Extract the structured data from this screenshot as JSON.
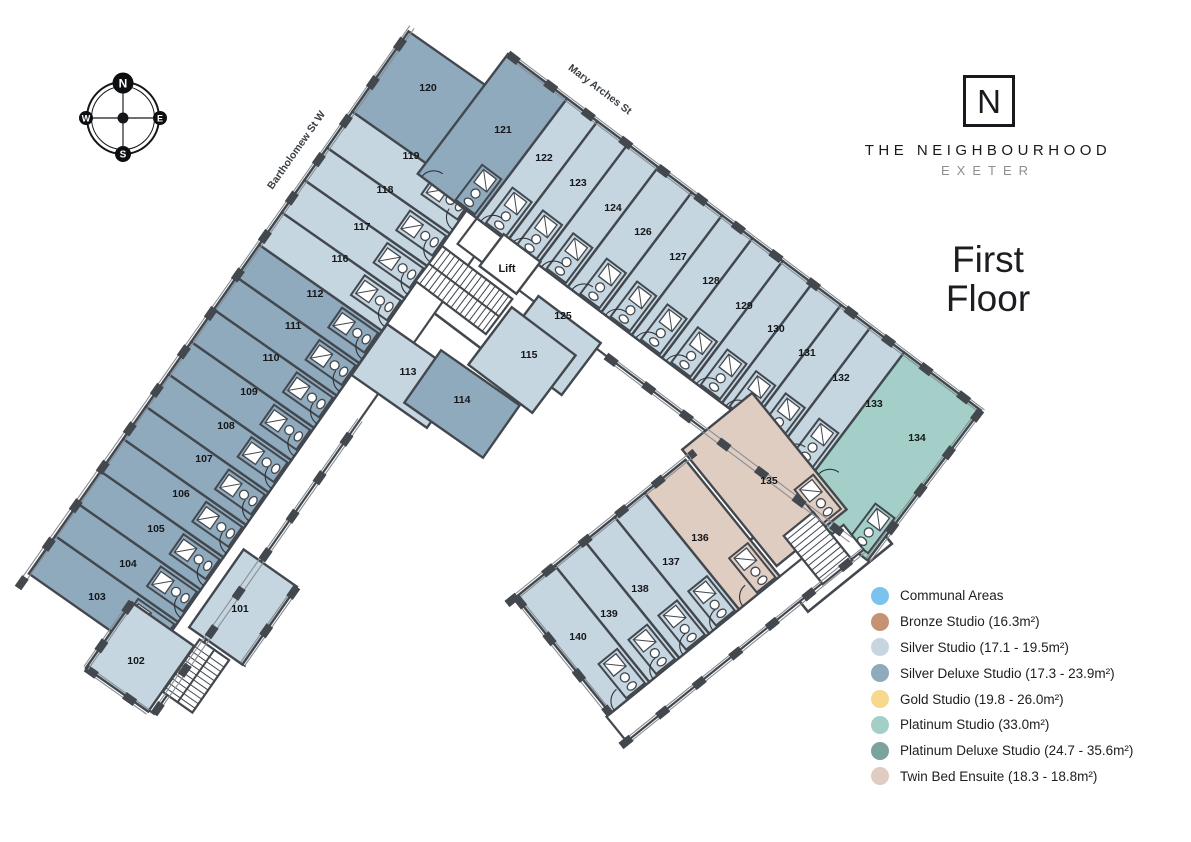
{
  "brand": {
    "logo_letter": "N",
    "name": "THE NEIGHBOURHOOD",
    "city": "EXETER"
  },
  "floor_title": {
    "line1": "First",
    "line2": "Floor"
  },
  "compass": {
    "north": "N",
    "east": "E",
    "south": "S",
    "west": "W"
  },
  "streets": {
    "west": "Bartholomew St W",
    "north": "Mary Arches St"
  },
  "lift_label": "Lift",
  "colors": {
    "wall": "#42484E",
    "window_line": "#888E94",
    "corridor": "#FFFFFF",
    "label_text": "#15171A",
    "categories": {
      "communal": "#79C3EE",
      "bronze": "#C59374",
      "silver": "#C6D6E1",
      "silver_deluxe": "#8FA9BD",
      "gold": "#F8D88D",
      "platinum": "#A3CFC8",
      "platinum_deluxe": "#7CA29C",
      "twin": "#E0CDC2"
    }
  },
  "legend": {
    "items": [
      {
        "label": "Communal Areas",
        "category": "communal"
      },
      {
        "label": "Bronze Studio (16.3m²)",
        "category": "bronze"
      },
      {
        "label": "Silver Studio (17.1 - 19.5m²)",
        "category": "silver"
      },
      {
        "label": "Silver Deluxe Studio (17.3 - 23.9m²)",
        "category": "silver_deluxe"
      },
      {
        "label": "Gold Studio (19.8 - 26.0m²)",
        "category": "gold"
      },
      {
        "label": "Platinum Studio (33.0m²)",
        "category": "platinum"
      },
      {
        "label": "Platinum Deluxe Studio (24.7 - 35.6m²)",
        "category": "platinum_deluxe"
      },
      {
        "label": "Twin Bed Ensuite (18.3 - 18.8m²)",
        "category": "twin"
      }
    ]
  },
  "rooms": [
    {
      "number": "101",
      "category": "silver"
    },
    {
      "number": "102",
      "category": "silver"
    },
    {
      "number": "103",
      "category": "silver_deluxe"
    },
    {
      "number": "104",
      "category": "silver_deluxe"
    },
    {
      "number": "105",
      "category": "silver_deluxe"
    },
    {
      "number": "106",
      "category": "silver_deluxe"
    },
    {
      "number": "107",
      "category": "silver_deluxe"
    },
    {
      "number": "108",
      "category": "silver_deluxe"
    },
    {
      "number": "109",
      "category": "silver_deluxe"
    },
    {
      "number": "110",
      "category": "silver_deluxe"
    },
    {
      "number": "111",
      "category": "silver_deluxe"
    },
    {
      "number": "112",
      "category": "silver_deluxe"
    },
    {
      "number": "113",
      "category": "silver"
    },
    {
      "number": "114",
      "category": "silver_deluxe"
    },
    {
      "number": "115",
      "category": "silver"
    },
    {
      "number": "116",
      "category": "silver"
    },
    {
      "number": "117",
      "category": "silver"
    },
    {
      "number": "118",
      "category": "silver"
    },
    {
      "number": "119",
      "category": "silver"
    },
    {
      "number": "120",
      "category": "silver_deluxe"
    },
    {
      "number": "121",
      "category": "silver_deluxe"
    },
    {
      "number": "122",
      "category": "silver"
    },
    {
      "number": "123",
      "category": "silver"
    },
    {
      "number": "124",
      "category": "silver"
    },
    {
      "number": "125",
      "category": "silver"
    },
    {
      "number": "126",
      "category": "silver"
    },
    {
      "number": "127",
      "category": "silver"
    },
    {
      "number": "128",
      "category": "silver"
    },
    {
      "number": "129",
      "category": "silver"
    },
    {
      "number": "130",
      "category": "silver"
    },
    {
      "number": "131",
      "category": "silver"
    },
    {
      "number": "132",
      "category": "silver"
    },
    {
      "number": "133",
      "category": "silver"
    },
    {
      "number": "134",
      "category": "platinum"
    },
    {
      "number": "135",
      "category": "twin"
    },
    {
      "number": "136",
      "category": "twin"
    },
    {
      "number": "137",
      "category": "silver"
    },
    {
      "number": "138",
      "category": "silver"
    },
    {
      "number": "139",
      "category": "silver"
    },
    {
      "number": "140",
      "category": "silver"
    }
  ]
}
